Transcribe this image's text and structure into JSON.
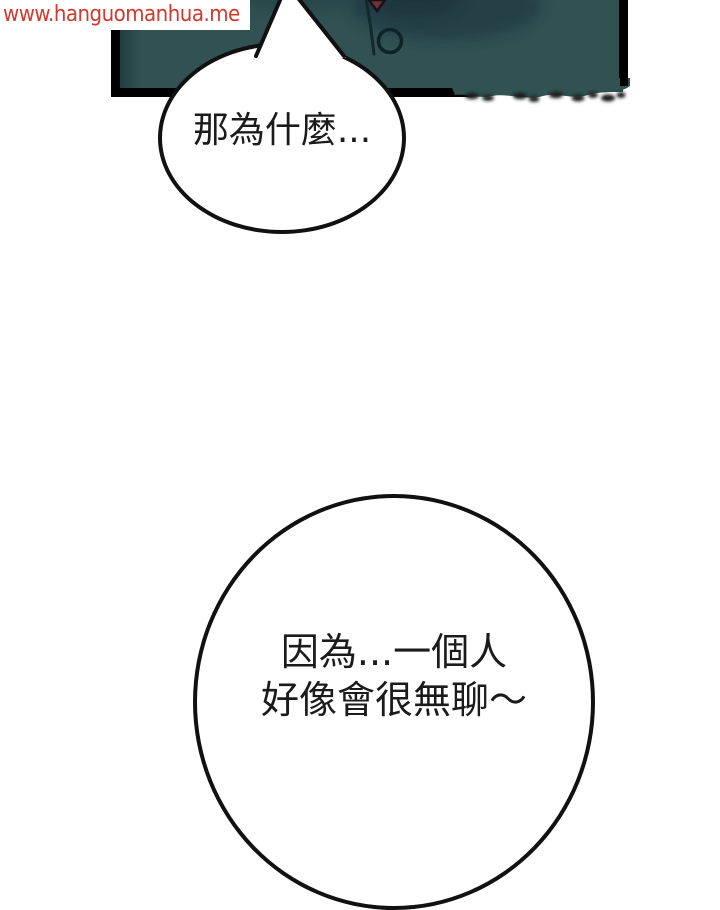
{
  "page": {
    "background_color": "#ffffff",
    "type": "comic-page"
  },
  "watermark": {
    "text": "www.hanguomanhua.me",
    "color": "#cf3a2d",
    "background": "#ffffff"
  },
  "panel": {
    "border_color": "#000000",
    "shirt_color": "#315152",
    "shirt_shadow_color": "#223e44",
    "seam_color": "#13292c",
    "collar_skin_color": "#6e3231",
    "button_outline_color": "#0e2325"
  },
  "speech_bubbles": [
    {
      "id": "top",
      "text": "那為什麼...",
      "fill": "#ffffff",
      "outline_color": "#111111"
    },
    {
      "id": "bottom",
      "lines": [
        "因為...一個人",
        "好像會很無聊～"
      ],
      "fill": "#ffffff",
      "outline_color": "#111111"
    }
  ]
}
